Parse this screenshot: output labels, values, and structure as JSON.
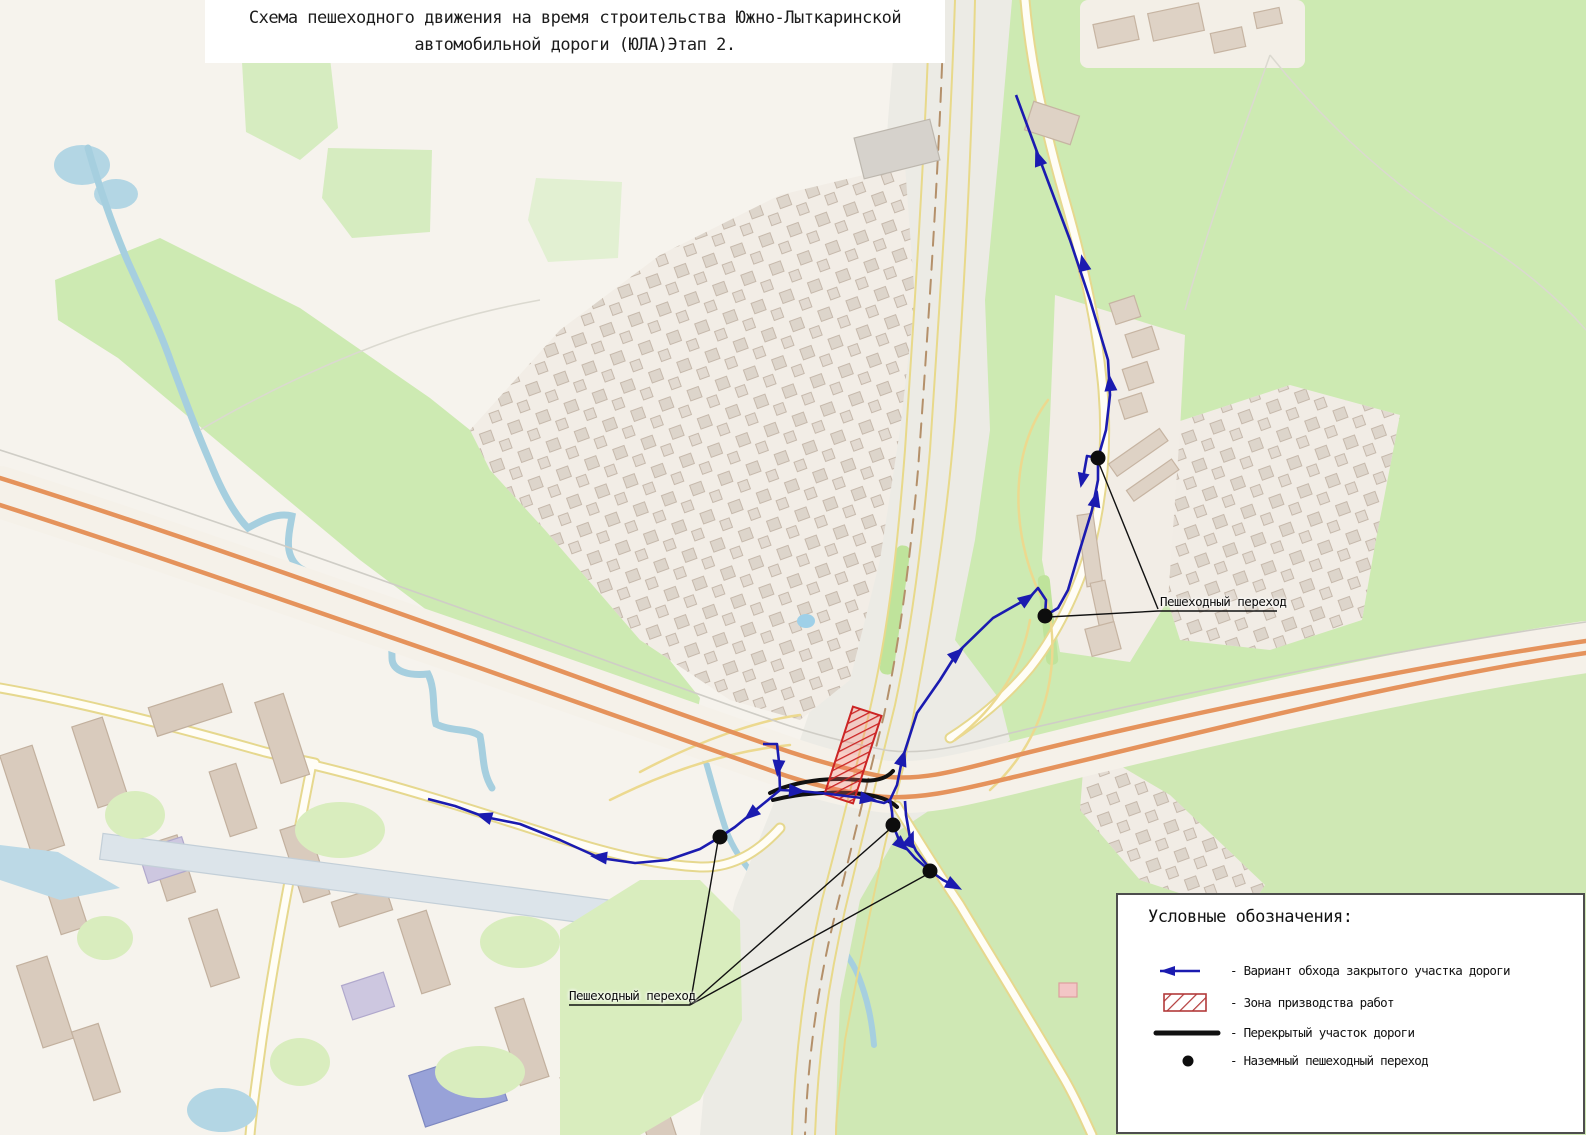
{
  "title": {
    "line1": "Схема пешеходного движения на время строительства Южно-Лыткаринской",
    "line2": "автомобильной дороги (ЮЛА)Этап 2."
  },
  "map_labels": [
    {
      "text": "Пешеходный переход"
    },
    {
      "text": "Пешеходный переход"
    }
  ],
  "legend": {
    "title": "Условные обозначения:",
    "items": [
      {
        "symbol": "detour-arrow-icon",
        "label": "- Вариант обхода закрытого участка дороги"
      },
      {
        "symbol": "work-zone-icon",
        "label": "- Зона призводства работ"
      },
      {
        "symbol": "closed-road-icon",
        "label": "- Перекрытый участок дороги"
      },
      {
        "symbol": "crossing-dot-icon",
        "label": "- Наземный пешеходный переход"
      }
    ]
  },
  "colors": {
    "detour_route": "#1b1bb0",
    "work_zone_red": "#cc2525",
    "closed_road": "#111111",
    "crossing_dot": "#0d0d0d",
    "water": "#a6cfdf",
    "grass": "#cdeab2",
    "highway_orange": "#e5935c"
  }
}
